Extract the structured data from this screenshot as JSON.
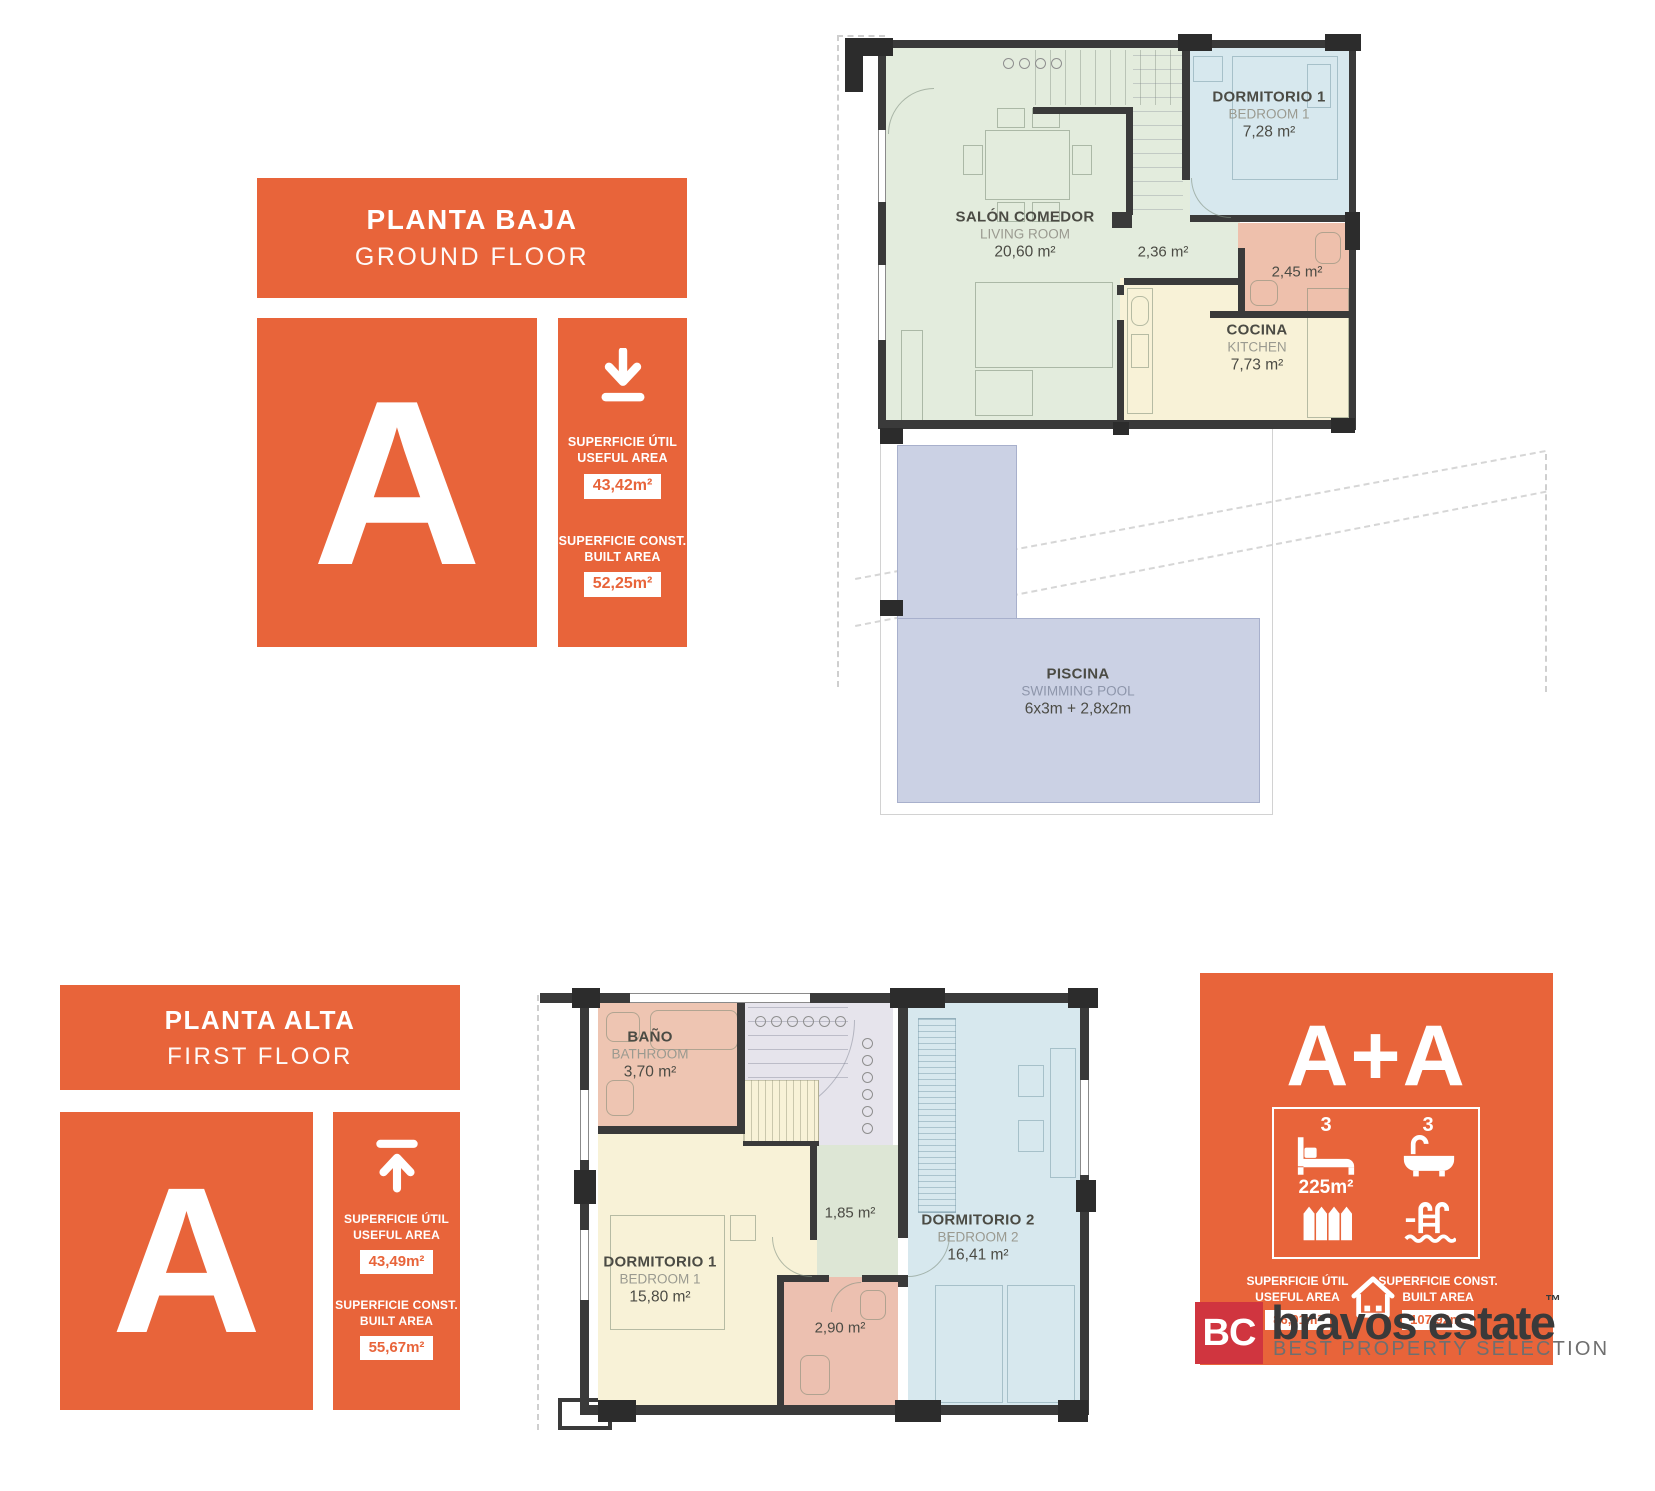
{
  "colors": {
    "accent_orange": "#E8643A",
    "logo_red": "#D0353F",
    "living_green": "#E3ECDD",
    "bedroom_blue": "#D7E8EE",
    "kitchen_yellow": "#F8F2D7",
    "bath_pink": "#EEC0AC",
    "pool_blue": "#CBD1E4",
    "stairs_gray": "#E6E4EC",
    "wall_dark": "#3A3A3A"
  },
  "icons": {
    "ground_panel": "download-icon",
    "first_panel": "upload-icon",
    "combo_features": [
      "bed-icon",
      "bath-icon",
      "fence-icon",
      "pool-icon"
    ],
    "combo_bottom": "house-icon"
  },
  "panels": {
    "ground": {
      "title_es": "PLANTA BAJA",
      "title_en": "GROUND FLOOR",
      "unit": "A",
      "useful_label_es": "SUPERFICIE ÚTIL",
      "useful_label_en": "USEFUL AREA",
      "useful_value": "43,42m²",
      "built_label_es": "SUPERFICIE CONST.",
      "built_label_en": "BUILT AREA",
      "built_value": "52,25m²"
    },
    "first": {
      "title_es": "PLANTA ALTA",
      "title_en": "FIRST FLOOR",
      "unit": "A",
      "useful_label_es": "SUPERFICIE ÚTIL",
      "useful_label_en": "USEFUL AREA",
      "useful_value": "43,49m²",
      "built_label_es": "SUPERFICIE CONST.",
      "built_label_en": "BUILT AREA",
      "built_value": "55,67m²"
    },
    "combo": {
      "title": "A+A",
      "bedrooms": "3",
      "bathrooms": "3",
      "plot_area": "225m²",
      "useful_label_es": "SUPERFICIE ÚTIL",
      "useful_label_en": "USEFUL AREA",
      "useful_value": "86,91m²",
      "built_label_es": "SUPERFICIE CONST.",
      "built_label_en": "BUILT AREA",
      "built_value": "107,92m²"
    }
  },
  "ground_plan": {
    "living": {
      "es": "SALÓN COMEDOR",
      "en": "LIVING ROOM",
      "area": "20,60 m²"
    },
    "bedroom1": {
      "es": "DORMITORIO 1",
      "en": "BEDROOM 1",
      "area": "7,28 m²"
    },
    "hall_area": "2,36 m²",
    "bath_area": "2,45 m²",
    "kitchen": {
      "es": "COCINA",
      "en": "KITCHEN",
      "area": "7,73 m²"
    },
    "pool": {
      "es": "PISCINA",
      "en": "SWIMMING POOL",
      "area": "6x3m + 2,8x2m"
    }
  },
  "first_plan": {
    "bath": {
      "es": "BAÑO",
      "en": "BATHROOM",
      "area": "3,70 m²"
    },
    "bedroom1": {
      "es": "DORMITORIO 1",
      "en": "BEDROOM 1",
      "area": "15,80 m²"
    },
    "hall_area": "1,85 m²",
    "wc_area": "2,90 m²",
    "bedroom2": {
      "es": "DORMITORIO 2",
      "en": "BEDROOM 2",
      "area": "16,41 m²"
    }
  },
  "logo": {
    "initials": "BC",
    "name": "bravos estate",
    "tm": "™",
    "tagline": "BEST PROPERTY SELECTION"
  }
}
